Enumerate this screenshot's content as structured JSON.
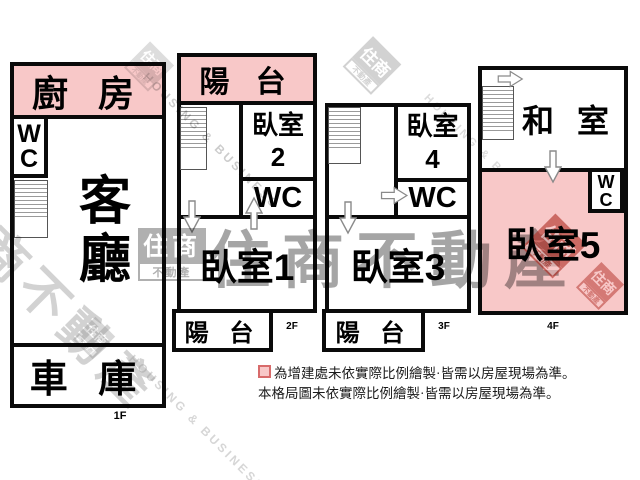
{
  "colors": {
    "pink": "#f8c8c8",
    "wall": "#0a0a0a",
    "legend_swatch_border": "#d86b6b",
    "watermark_gray": "#8f8f8f",
    "watermark_red": "#b5372c"
  },
  "floor1": {
    "kitchen": "廚 房",
    "wc": "WC",
    "living": "客廳",
    "garage": "車 庫",
    "label": "1F"
  },
  "floor2": {
    "balcony_top": "陽 台",
    "bedroom2_name": "臥室",
    "bedroom2_no": "2",
    "wc": "WC",
    "bedroom1": "臥室1",
    "balcony_bottom": "陽 台",
    "label": "2F"
  },
  "floor3": {
    "bedroom4_name": "臥室",
    "bedroom4_no": "4",
    "wc": "WC",
    "bedroom3": "臥室3",
    "balcony_bottom": "陽 台",
    "label": "3F"
  },
  "floor4": {
    "tatami": "和 室",
    "wc": "WC",
    "bedroom5": "臥室5",
    "label": "4F"
  },
  "legend": {
    "line1": "為增建處未依實際比例繪製·皆需以房屋現場為準。",
    "line2": "本格局圖未依實際比例繪製·皆需以房屋現場為準。"
  },
  "watermark": {
    "brand": "住商不動產",
    "logo_main": "住商",
    "logo_sub": "不動產",
    "latin": "HOUSING & BUSINESS",
    "latin_short": "HOUSING & B"
  }
}
